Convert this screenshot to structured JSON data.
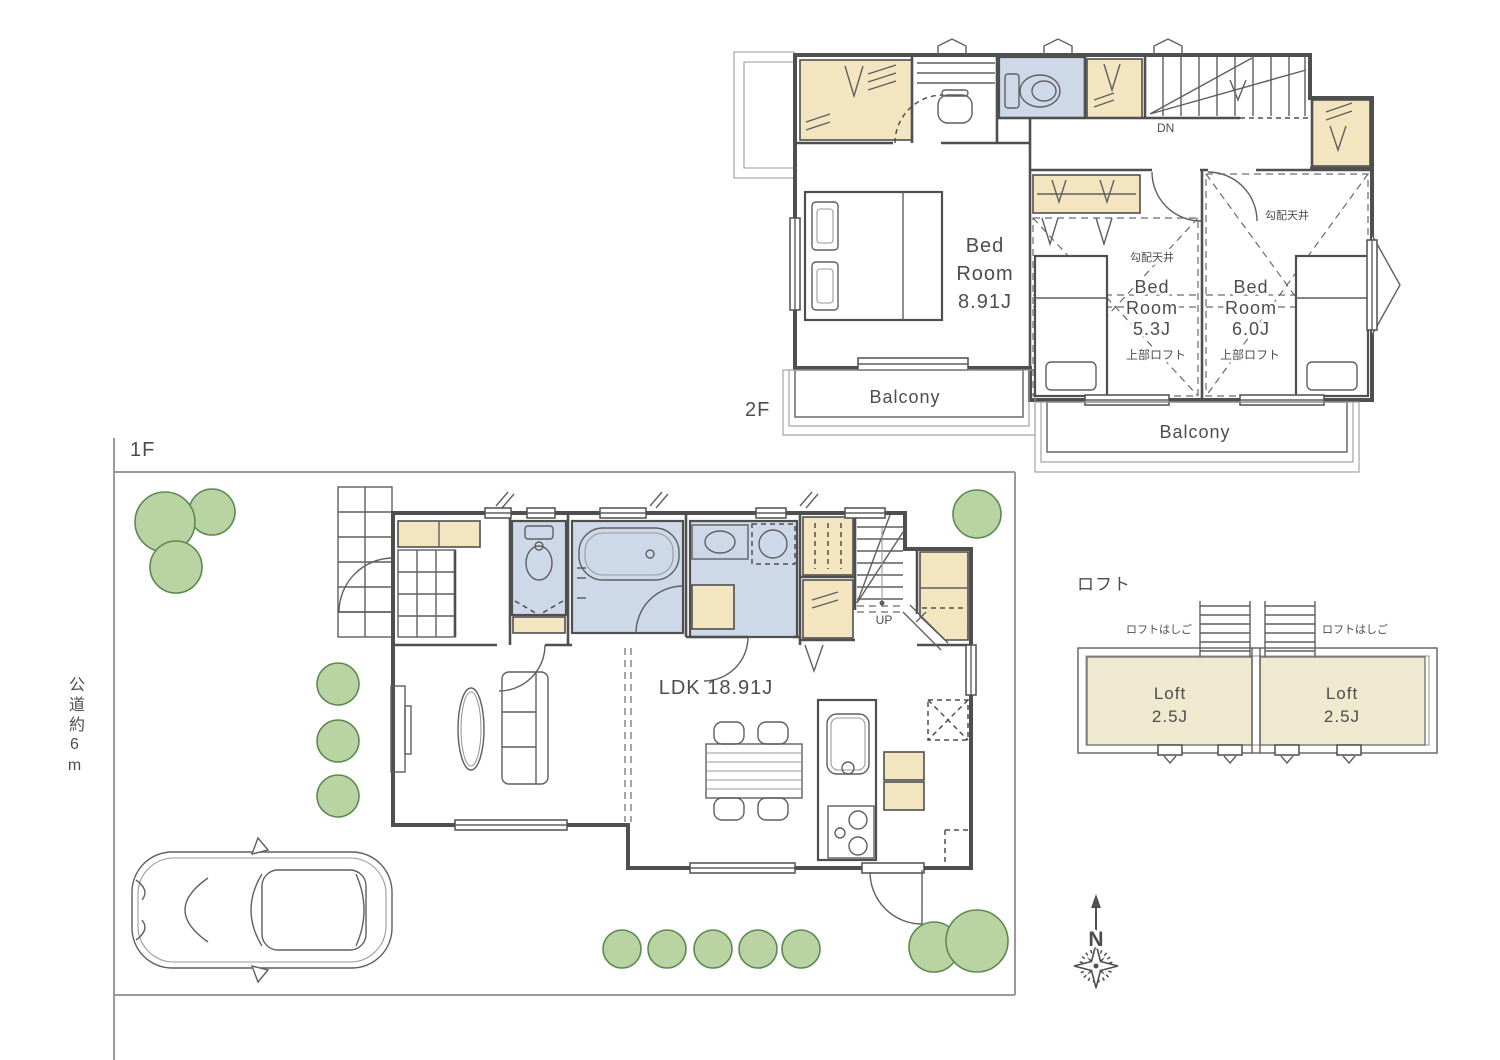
{
  "plan": {
    "f2": {
      "floor_label": "2F",
      "master_bedroom": {
        "lines": [
          "Bed",
          "Room",
          "8.91J"
        ]
      },
      "bedroom_2": {
        "lines": [
          "Bed",
          "Room",
          "5.3J"
        ],
        "sloped_ceiling": "勾配天井",
        "upper_loft": "上部ロフト"
      },
      "bedroom_3": {
        "lines": [
          "Bed",
          "Room",
          "6.0J"
        ],
        "sloped_ceiling": "勾配天井",
        "upper_loft": "上部ロフト"
      },
      "balcony_left": "Balcony",
      "balcony_right": "Balcony",
      "stairs_label": "DN"
    },
    "f1": {
      "floor_label": "1F",
      "ldk_label": "LDK 18.91J",
      "stairs_label": "UP",
      "road_label": "公道約6m"
    },
    "loft": {
      "section_label": "ロフト",
      "ladder_label_left": "ロフトはしご",
      "ladder_label_right": "ロフトはしご",
      "room_left": {
        "lines": [
          "Loft",
          "2.5J"
        ]
      },
      "room_right": {
        "lines": [
          "Loft",
          "2.5J"
        ]
      }
    },
    "compass_north": "N"
  },
  "colors": {
    "closet_fill": "#F2E5C0",
    "wet_area_fill": "#CDD9E8",
    "loft_fill": "#EFE9CF",
    "tree_fill": "#B9D3A2",
    "tree_stroke": "#5C8A52",
    "wall": "#4F4F4F",
    "text": "#4D4D4D"
  }
}
